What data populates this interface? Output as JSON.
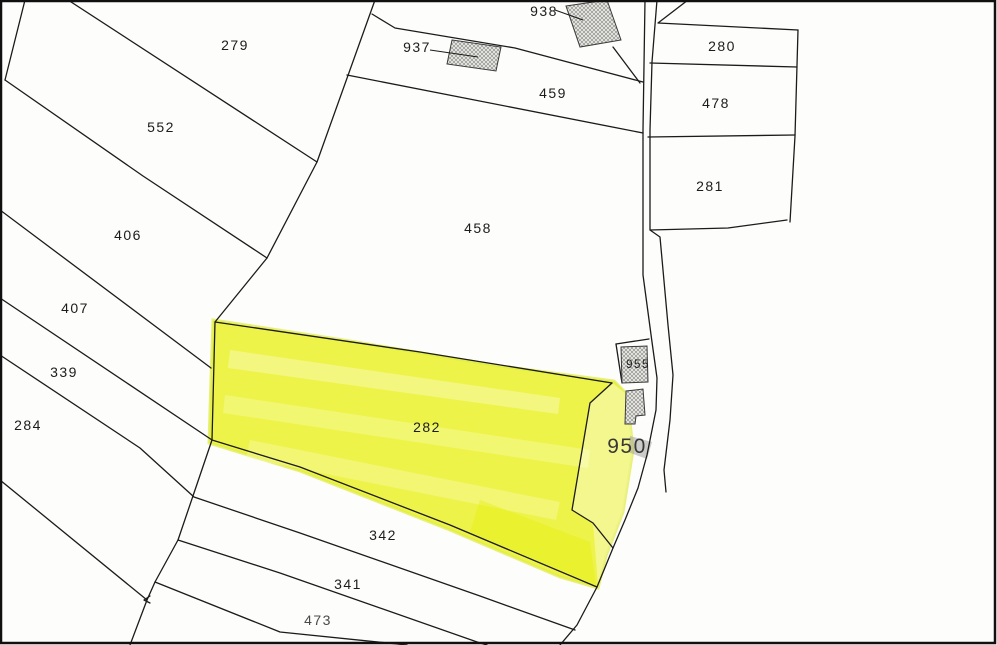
{
  "map": {
    "background_color": "#fdfdfb",
    "ink_color": "#1c1c1c",
    "highlight_color": "#ecf336",
    "building_fill": "hatched-gray",
    "highlighted_parcel": "282",
    "labels": [
      {
        "text": "279",
        "x": 235,
        "y": 50
      },
      {
        "text": "552",
        "x": 161,
        "y": 132
      },
      {
        "text": "406",
        "x": 128,
        "y": 240
      },
      {
        "text": "407",
        "x": 75,
        "y": 313
      },
      {
        "text": "339",
        "x": 64,
        "y": 377
      },
      {
        "text": "284",
        "x": 28,
        "y": 430
      },
      {
        "text": "937",
        "x": 417,
        "y": 52
      },
      {
        "text": "938",
        "x": 544,
        "y": 16
      },
      {
        "text": "459",
        "x": 553,
        "y": 98
      },
      {
        "text": "458",
        "x": 478,
        "y": 233
      },
      {
        "text": "280",
        "x": 722,
        "y": 51
      },
      {
        "text": "478",
        "x": 716,
        "y": 108
      },
      {
        "text": "281",
        "x": 710,
        "y": 191
      },
      {
        "text": "282",
        "x": 427,
        "y": 432
      },
      {
        "text": "955",
        "x": 638,
        "y": 368,
        "size": 11.5
      },
      {
        "text": "950",
        "x": 627,
        "y": 453,
        "size": 21,
        "color": "#383838"
      },
      {
        "text": "342",
        "x": 383,
        "y": 540
      },
      {
        "text": "341",
        "x": 348,
        "y": 589
      },
      {
        "text": "473",
        "x": 318,
        "y": 625,
        "color": "#4a4a4a"
      }
    ]
  }
}
